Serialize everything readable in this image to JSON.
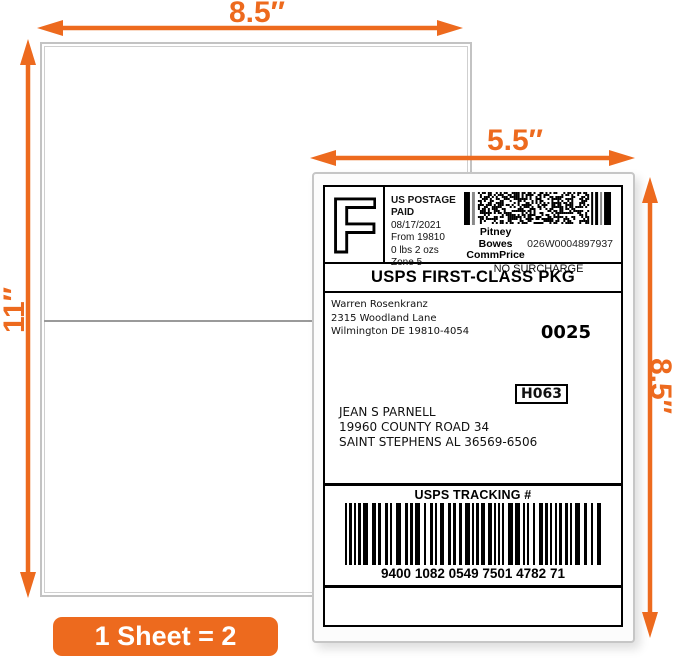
{
  "colors": {
    "accent_orange": "#ED6A1E",
    "sheet_border_gray": "#c3c3c3",
    "label_border_gray": "#c6c6c6"
  },
  "dimensions": {
    "sheet_width": "8.5″",
    "sheet_height": "11″",
    "label_width": "5.5″",
    "label_height": "8.5″"
  },
  "badge": {
    "text": "1 Sheet = 2 Labels"
  },
  "shipping_label": {
    "postage_block": {
      "logo_letter": "F",
      "paid_lines": [
        "US POSTAGE",
        "PAID"
      ],
      "info_lines": [
        "08/17/2021",
        "From 19810",
        "0 lbs 2 ozs",
        "Zone 5"
      ],
      "carrier_line1": "Pitney Bowes",
      "carrier_line2": "CommPrice",
      "meter_number": "026W0004897937",
      "surcharge_note": "NO SURCHARGE"
    },
    "service_class": "USPS FIRST-CLASS PKG",
    "sender": {
      "lines": [
        "Warren Rosenkranz",
        "2315 Woodland Lane",
        "Wilmington DE 19810-4054"
      ]
    },
    "batch_number": "0025",
    "sort_code": "H063",
    "recipient": {
      "lines": [
        "JEAN S PARNELL",
        "19960 COUNTY ROAD 34",
        "SAINT STEPHENS AL 36569-6506"
      ]
    },
    "tracking": {
      "title": "USPS TRACKING #",
      "number": "9400 1082 0549 7501 4782 71"
    }
  }
}
